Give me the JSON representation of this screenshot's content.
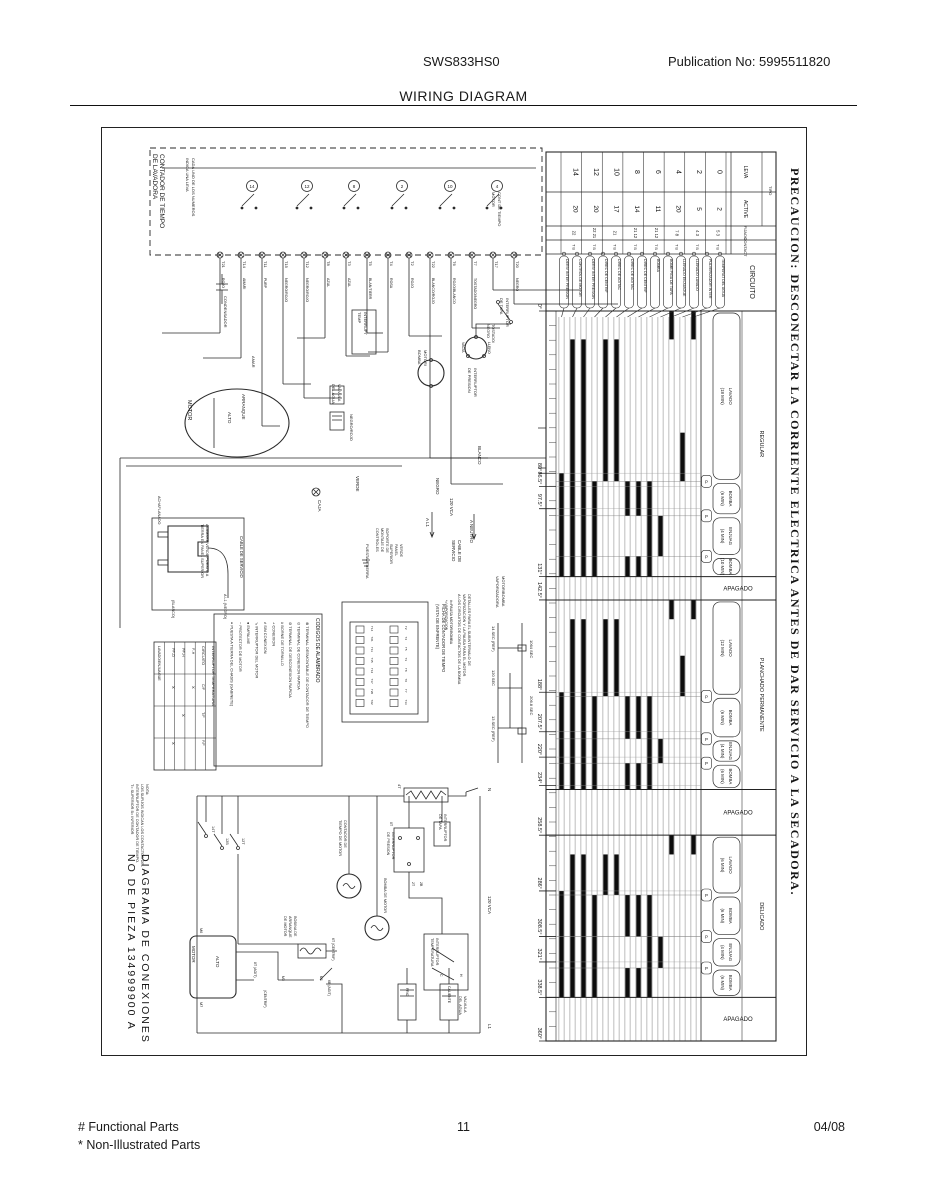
{
  "page": {
    "model": "SWS833HS0",
    "publication": "Publication No:  5995511820",
    "title": "WIRING DIAGRAM",
    "footer_left_1": "# Functional Parts",
    "footer_left_2": "* Non-Illustrated Parts",
    "page_number": "11",
    "footer_date": "04/08"
  },
  "diagram": {
    "precaucion": "PRECAUCION:  DESCONECTAR  LA  CORRIENTE  ELECTRICA  ANTES  DE  DAR  SERVICIO  A  LA  SECADORA.",
    "part_title_1": "DIAGRAMA DE CONEXIONES",
    "part_title_2": "NO DE PIEZA 134999900 A",
    "labels": {
      "contador_1": "CONTADOR DE TIEMPO",
      "contador_2": "DE LAVADORA",
      "cada_1": "CADA UNO DE LOS NUMEROS",
      "cada_2": "INDICA UNA LEVA",
      "cont_motor_1": "CONT DE TIEMPO",
      "cont_motor_2": "MOTOR",
      "condensador": "CONDENSADOR",
      "motor": "MOTOR",
      "alto": "ALTO",
      "arranque": "ARRANQUE",
      "amar": "AMAR",
      "interrupt_temp_1": "INTERRUPT",
      "interrupt_temp_2": "TEMP",
      "inter_tapa_1": "INTERRUPTOR",
      "inter_tapa_2": "DE TAPA",
      "tostado_1": "TOSTADO/",
      "tostado_2": "NEGRO",
      "inter_presion_1": "INTERRUPTOR",
      "inter_presion_2": "DE PRESION",
      "lleno": "LLENO",
      "vacia": "VACIA",
      "valvula_1": "VALVULA",
      "valvula_2": "DEL AGUA",
      "negro_rojo": "NEGRO/ROJO",
      "motor_bomba_1": "MOTOR/",
      "motor_bomba_2": "BOMBA",
      "vapor_1": "MOTOR/BOMBA",
      "vapor_2": "VAPORIZADORA",
      "blanco": "BLANCO",
      "negro": "NEGRO",
      "vca": "120 VCA",
      "a_l1": "A L1",
      "a_neutro": "A NEUTRO",
      "cable_1": "CABLE DE",
      "cable_2": "SERVICIO",
      "verde": "VERDE",
      "caja": "CAJA",
      "puesta": "PUESTA A TIERRA",
      "soporte_1": "SOPORTE DE",
      "soporte_2": "MONTAJE DE",
      "soporte_3": "CONTROLES",
      "verde_panel_1": "VERDE",
      "verde_panel_2": "PANEL",
      "verde_panel_3": "SUPERIOR",
      "alambre_1": "ALAMBRE VERDE PUESTO A",
      "alambre_2": "TIERRA EN PANEL SUPERIOR",
      "blanco_p": "(BLANCO)",
      "negro_p": "A L1 (NEGRO)",
      "achaflanado": "ACHAFLANADO",
      "cable_serv": "CABLE DE SERVICIO",
      "motor_lower": "MOTOR",
      "alto_lower": "ALTO",
      "m6": "M6",
      "m7": "M7",
      "t14t": "14T",
      "t12b": "12B",
      "t12t": "12T",
      "cont_tiempo_1": "CONTADOR DE",
      "cont_tiempo_2": "TIEMPO DE MOTOR",
      "bomba_motor": "BOMBA DE MOTOR",
      "bobina_1": "BOBINA DE",
      "bobina_2": "ARRANQUE",
      "bobina_3": "DE MOTOR",
      "agit8t": "8T (AGIT)",
      "centrif_b": "(CENTRIF)",
      "m3": "M3",
      "m1": "M1",
      "b6": "6B (AGIT)",
      "t6cent": "6T (CENTRIF)",
      "t4b": "4T",
      "presion_low_1": "INTERRUPTOR",
      "presion_low_2": "DE PRESION",
      "tapa_low_1": "INTERRUPTOR",
      "tapa_low_2": "DE TAPA",
      "temp_low_1": "INTERRUPTOR",
      "temp_low_2": "TEMPERATURA",
      "valv_low_1": "VALVULA",
      "valv_low_2": "DEL AGUA",
      "frio": "FRIO",
      "caliente": "CALIENTE",
      "vca_low": "120 VCA",
      "n_label": "N",
      "l1_label": "L1",
      "t0t": "0T",
      "t2t": "2T",
      "t2b": "2B",
      "h_term": "H",
      "c_term": "C"
    },
    "terminals": [
      {
        "t": "T21",
        "c": "ROJO"
      },
      {
        "t": "T14",
        "c": "AMARI"
      },
      {
        "t": "T11",
        "c": "PURP"
      },
      {
        "t": "T15",
        "c": "NEGRO/ROJO"
      },
      {
        "t": "T12",
        "c": "NEGRO/ROJO"
      },
      {
        "t": "T8",
        "c": "AZUL"
      },
      {
        "t": "T3",
        "c": "AZUL"
      },
      {
        "t": "T5",
        "c": "BLAN/TIERR"
      },
      {
        "t": "T4",
        "c": "ROSA"
      },
      {
        "t": "T2",
        "c": "ROJO"
      },
      {
        "t": "T22",
        "c": "BLANCO/ROJO"
      },
      {
        "t": "T6",
        "c": "ROJO/BLANCO"
      },
      {
        "t": "T7",
        "c": "TOSTADO/NEGRO"
      },
      {
        "t": "T17",
        "c": ""
      },
      {
        "t": "T20",
        "c": "NEGRO"
      }
    ],
    "cams": [
      "14",
      "12",
      "8",
      "2",
      "10",
      "4"
    ],
    "legend": {
      "title": "CODIGOS DE ALAMBRADO",
      "items": [
        {
          "symbol": "⊗",
          "text": "TERMINAL DESMONTABLE DE CONTADOR DE TIEMPO"
        },
        {
          "symbol": "⊙",
          "text": "TERMINAL DE CONEXION RAPIDA"
        },
        {
          "symbol": "⊘",
          "text": "TERMINAL DE DESCONEXION RAPIDA"
        },
        {
          "symbol": "#",
          "text": "BORNE DE TORNILLO"
        },
        {
          "symbol": "+",
          "text": "CONEXION"
        },
        {
          "symbol": "≠",
          "text": "SIN CONEXION"
        },
        {
          "symbol": "↘",
          "text": "INTERRUPTOR DEL MOTOR"
        },
        {
          "symbol": "●",
          "text": "EMPALME"
        },
        {
          "symbol": "~",
          "text": "PROTECTOR DE MOTOR"
        },
        {
          "symbol": "≡",
          "text": "PUESTA A TIERRA DEL CHASIS (GABINETE)"
        }
      ]
    },
    "ficha": {
      "title_1": "FICHA DE CONTADOR DE TIEMPO",
      "title_2": "(VISTA DE ENFRENTE)",
      "pins": [
        "T14",
        "T21",
        "T11",
        "T15",
        "T12",
        "T17",
        "T20",
        "T22",
        "T2",
        "T4",
        "T5",
        "T3",
        "T8",
        "T6",
        "T7",
        "T13"
      ]
    },
    "temp_table": {
      "title": "INTERRUPTOR TEMPERATURA",
      "circuito": "CIRCUITO",
      "extra": "LAVADO/ENJUAGUE",
      "col_labels": [
        "C/F",
        "T/F",
        "F/F"
      ],
      "rows": [
        {
          "label": "F-H",
          "marks": [
            "X",
            "",
            ""
          ]
        },
        {
          "label": "PF-H",
          "marks": [
            "",
            "X",
            ""
          ]
        },
        {
          "label": "PF-D",
          "marks": [
            "X",
            "",
            "X"
          ]
        }
      ]
    },
    "timing": {
      "note_1": "DETALLES PARA EL SUBINTERVALO DE",
      "note_2": "VAPORIZACION Y LA PAUSA PARA EL MOTOR",
      "note_3": "A LOS CIRCUITOS DE CONTACTOS DE LA BOMBA",
      "legend_1": "#=PAUSA MOTOR/BOMBA",
      "legend_2": "*=VAPORIZACION",
      "t1": "1064 SEC",
      "t2": "120 SEC",
      "t3": "14 SEC (REF)",
      "t4": "13 SEC (REF)",
      "t5": "206.8 SEC"
    },
    "nota": {
      "l1": "NOTA:",
      "l2": "LOS SUFIJOS INDICAN LOS CONTACTOS DEL",
      "l3": "INTERRUPTOR DE CONTADOR DE TIEMPO.",
      "l4": "T= SUPERIOR   B= INFERIOR"
    }
  },
  "chart_data": {
    "type": "timer-cam-chart",
    "title": "CONTADOR DE TIEMPO DE LAVADORA",
    "degree_range": [
      0,
      360
    ],
    "degree_ticks_labeled": [
      0,
      80,
      86.5,
      97.5,
      131,
      142.5,
      188,
      207.5,
      220,
      234,
      258.5,
      286,
      308.5,
      321,
      338.5,
      360
    ],
    "minor_tick_step": 7.2,
    "header": {
      "tipo_label": "TIPO",
      "col_labels": [
        "LEVA",
        "ACTIVE",
        "FIJADO",
        "CONTACT"
      ],
      "circuito_label": "CIRCUITO",
      "leva": [
        "0",
        "2",
        "4",
        "6",
        "8",
        "10",
        "12",
        "14"
      ],
      "active": [
        "2",
        "5",
        "20",
        "11",
        "14",
        "17",
        "20",
        "20"
      ],
      "fijado": [
        "5 3",
        "4 3",
        "7 8",
        "21 12",
        "21 12",
        "21",
        "22 21",
        "22"
      ],
      "contact": [
        "T B",
        "T B",
        "T B",
        "T B",
        "T B",
        "T B",
        "T B",
        "T B"
      ]
    },
    "circuits": [
      "TEMPERAT DEL AGUA",
      "PULVERIZADOR INTER",
      "LLENADO LAVADO",
      "LLENADO ENJUAGUE",
      "BOMB PIGA DE TAPA",
      "BOMBA",
      "DIREC DE CENTRIF",
      "DIREC DE AGITAC",
      "DIREC DE AGITAC",
      "DIREC DE CENTRIF",
      "DERIV INTER PRESION",
      "CONTROL DE MOTOR",
      "DERIV INTER PRESION"
    ],
    "sections": [
      {
        "name": "REGULAR",
        "start": 0,
        "end": 131,
        "pauses": [
          84,
          101,
          121
        ],
        "phases": [
          {
            "label": "LAVADO (18 MIN)",
            "start": 0,
            "end": 84
          },
          {
            "label": "BOMBA (6 MIN)",
            "start": 84,
            "end": 101
          },
          {
            "label": "ENJUAG (4 MIN)",
            "start": 101,
            "end": 121
          },
          {
            "label": "BOMBA (10 MIN)",
            "start": 121,
            "end": 131
          }
        ]
      },
      {
        "name": "APAGADO",
        "start": 131,
        "end": 142.5,
        "pauses": [],
        "phases": []
      },
      {
        "name": "PLANCHADO PERMANENTE",
        "start": 142.5,
        "end": 236,
        "pauses": [
          190,
          211,
          223
        ],
        "phases": [
          {
            "label": "LAVADO (12 MIN)",
            "start": 142.5,
            "end": 190
          },
          {
            "label": "BOMBA (6 MIN)",
            "start": 190,
            "end": 211
          },
          {
            "label": "ENJUAG (4 MIN)",
            "start": 211,
            "end": 223
          },
          {
            "label": "BOMBA (6 MIN)",
            "start": 223,
            "end": 236
          }
        ]
      },
      {
        "name": "APAGADO",
        "start": 236,
        "end": 258.5,
        "pauses": [],
        "phases": []
      },
      {
        "name": "DELICADO",
        "start": 258.5,
        "end": 338.5,
        "pauses": [
          288,
          308.5,
          324
        ],
        "phases": [
          {
            "label": "LAVADO (6 MIN)",
            "start": 258.5,
            "end": 288
          },
          {
            "label": "BOMBA (6 MIN)",
            "start": 288,
            "end": 308.5
          },
          {
            "label": "ENJUAG (4 MIN)",
            "start": 308.5,
            "end": 324
          },
          {
            "label": "BOMBA (6 MIN)",
            "start": 324,
            "end": 338.5
          }
        ]
      },
      {
        "name": "APAGADO",
        "start": 338.5,
        "end": 360,
        "pauses": [],
        "phases": []
      }
    ],
    "bars": [
      [
        [
          0,
          14
        ],
        [
          142.5,
          152
        ],
        [
          258.5,
          268
        ]
      ],
      [
        [
          60,
          84
        ],
        [
          170,
          190
        ]
      ],
      [
        [
          0,
          14
        ],
        [
          142.5,
          152
        ],
        [
          258.5,
          268
        ]
      ],
      [
        [
          101,
          121
        ],
        [
          211,
          223
        ],
        [
          308.5,
          324
        ]
      ],
      [
        [
          84,
          131
        ],
        [
          190,
          236
        ],
        [
          288,
          338.5
        ]
      ],
      [
        [
          84,
          101
        ],
        [
          121,
          131
        ],
        [
          190,
          211
        ],
        [
          223,
          236
        ],
        [
          288,
          308.5
        ],
        [
          324,
          338.5
        ]
      ],
      [
        [
          84,
          101
        ],
        [
          121,
          131
        ],
        [
          190,
          211
        ],
        [
          223,
          236
        ],
        [
          288,
          308.5
        ],
        [
          324,
          338.5
        ]
      ],
      [
        [
          14,
          84
        ],
        [
          152,
          190
        ],
        [
          268,
          288
        ]
      ],
      [
        [
          14,
          84
        ],
        [
          152,
          190
        ],
        [
          268,
          288
        ]
      ],
      [
        [
          84,
          131
        ],
        [
          190,
          236
        ],
        [
          288,
          338.5
        ]
      ],
      [
        [
          14,
          131
        ],
        [
          152,
          236
        ],
        [
          268,
          338.5
        ]
      ],
      [
        [
          14,
          131
        ],
        [
          152,
          236
        ],
        [
          268,
          338.5
        ]
      ],
      [
        [
          80,
          131
        ],
        [
          188,
          236
        ],
        [
          286,
          338.5
        ]
      ]
    ]
  }
}
